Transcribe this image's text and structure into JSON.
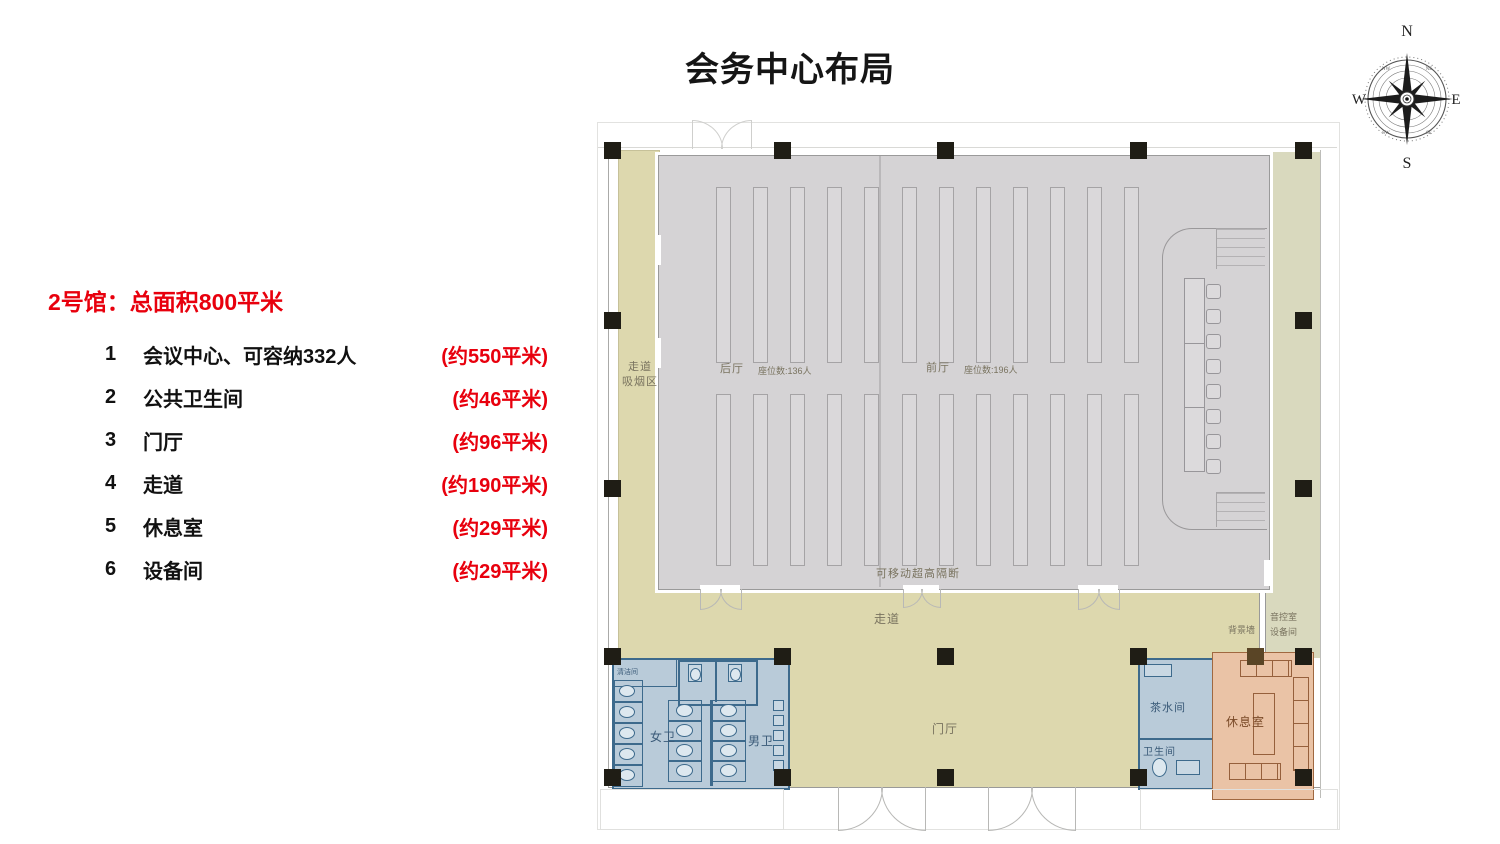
{
  "page": {
    "title": "会务中心布局"
  },
  "colors": {
    "accent": "#e8000d",
    "hall": "#d5d3d5",
    "beige": "#ddd8ae",
    "beige2": "#d9d9be",
    "blue": "#b9cbd9",
    "blueline": "#3d6a8c",
    "salmon": "#eac3a6",
    "salmonline": "#96603c",
    "col": "#1f1d15",
    "colbrown": "#5a4526"
  },
  "compass": {
    "n": "N",
    "e": "E",
    "s": "S",
    "w": "W",
    "ne": "NE",
    "nw": "NW",
    "se": "SE",
    "sw": "SW"
  },
  "info": {
    "heading": "2号馆：总面积800平米",
    "items": [
      {
        "num": "1",
        "label": "会议中心、可容纳332人",
        "area": "(约550平米)"
      },
      {
        "num": "2",
        "label": "公共卫生间",
        "area": "(约46平米)"
      },
      {
        "num": "3",
        "label": "门厅",
        "area": "(约96平米)"
      },
      {
        "num": "4",
        "label": "走道",
        "area": "(约190平米)"
      },
      {
        "num": "5",
        "label": "休息室",
        "area": "(约29平米)"
      },
      {
        "num": "6",
        "label": "设备间",
        "area": "(约29平米)"
      }
    ]
  },
  "plan": {
    "hall": {
      "back": "后厅",
      "back_seats": "座位数:136人",
      "front": "前厅",
      "front_seats": "座位数:196人",
      "partition": "可移动超高隔断"
    },
    "smoking": {
      "line1": "走道",
      "line2": "吸烟区"
    },
    "corridor": "走道",
    "lobby": "门厅",
    "women": "女卫",
    "men": "男卫",
    "clean": "清洁间",
    "tea": "茶水间",
    "toilet": "卫生间",
    "lounge": "休息室",
    "bgwall": "背景墙",
    "sound1": "音控室",
    "sound2": "设备间"
  }
}
